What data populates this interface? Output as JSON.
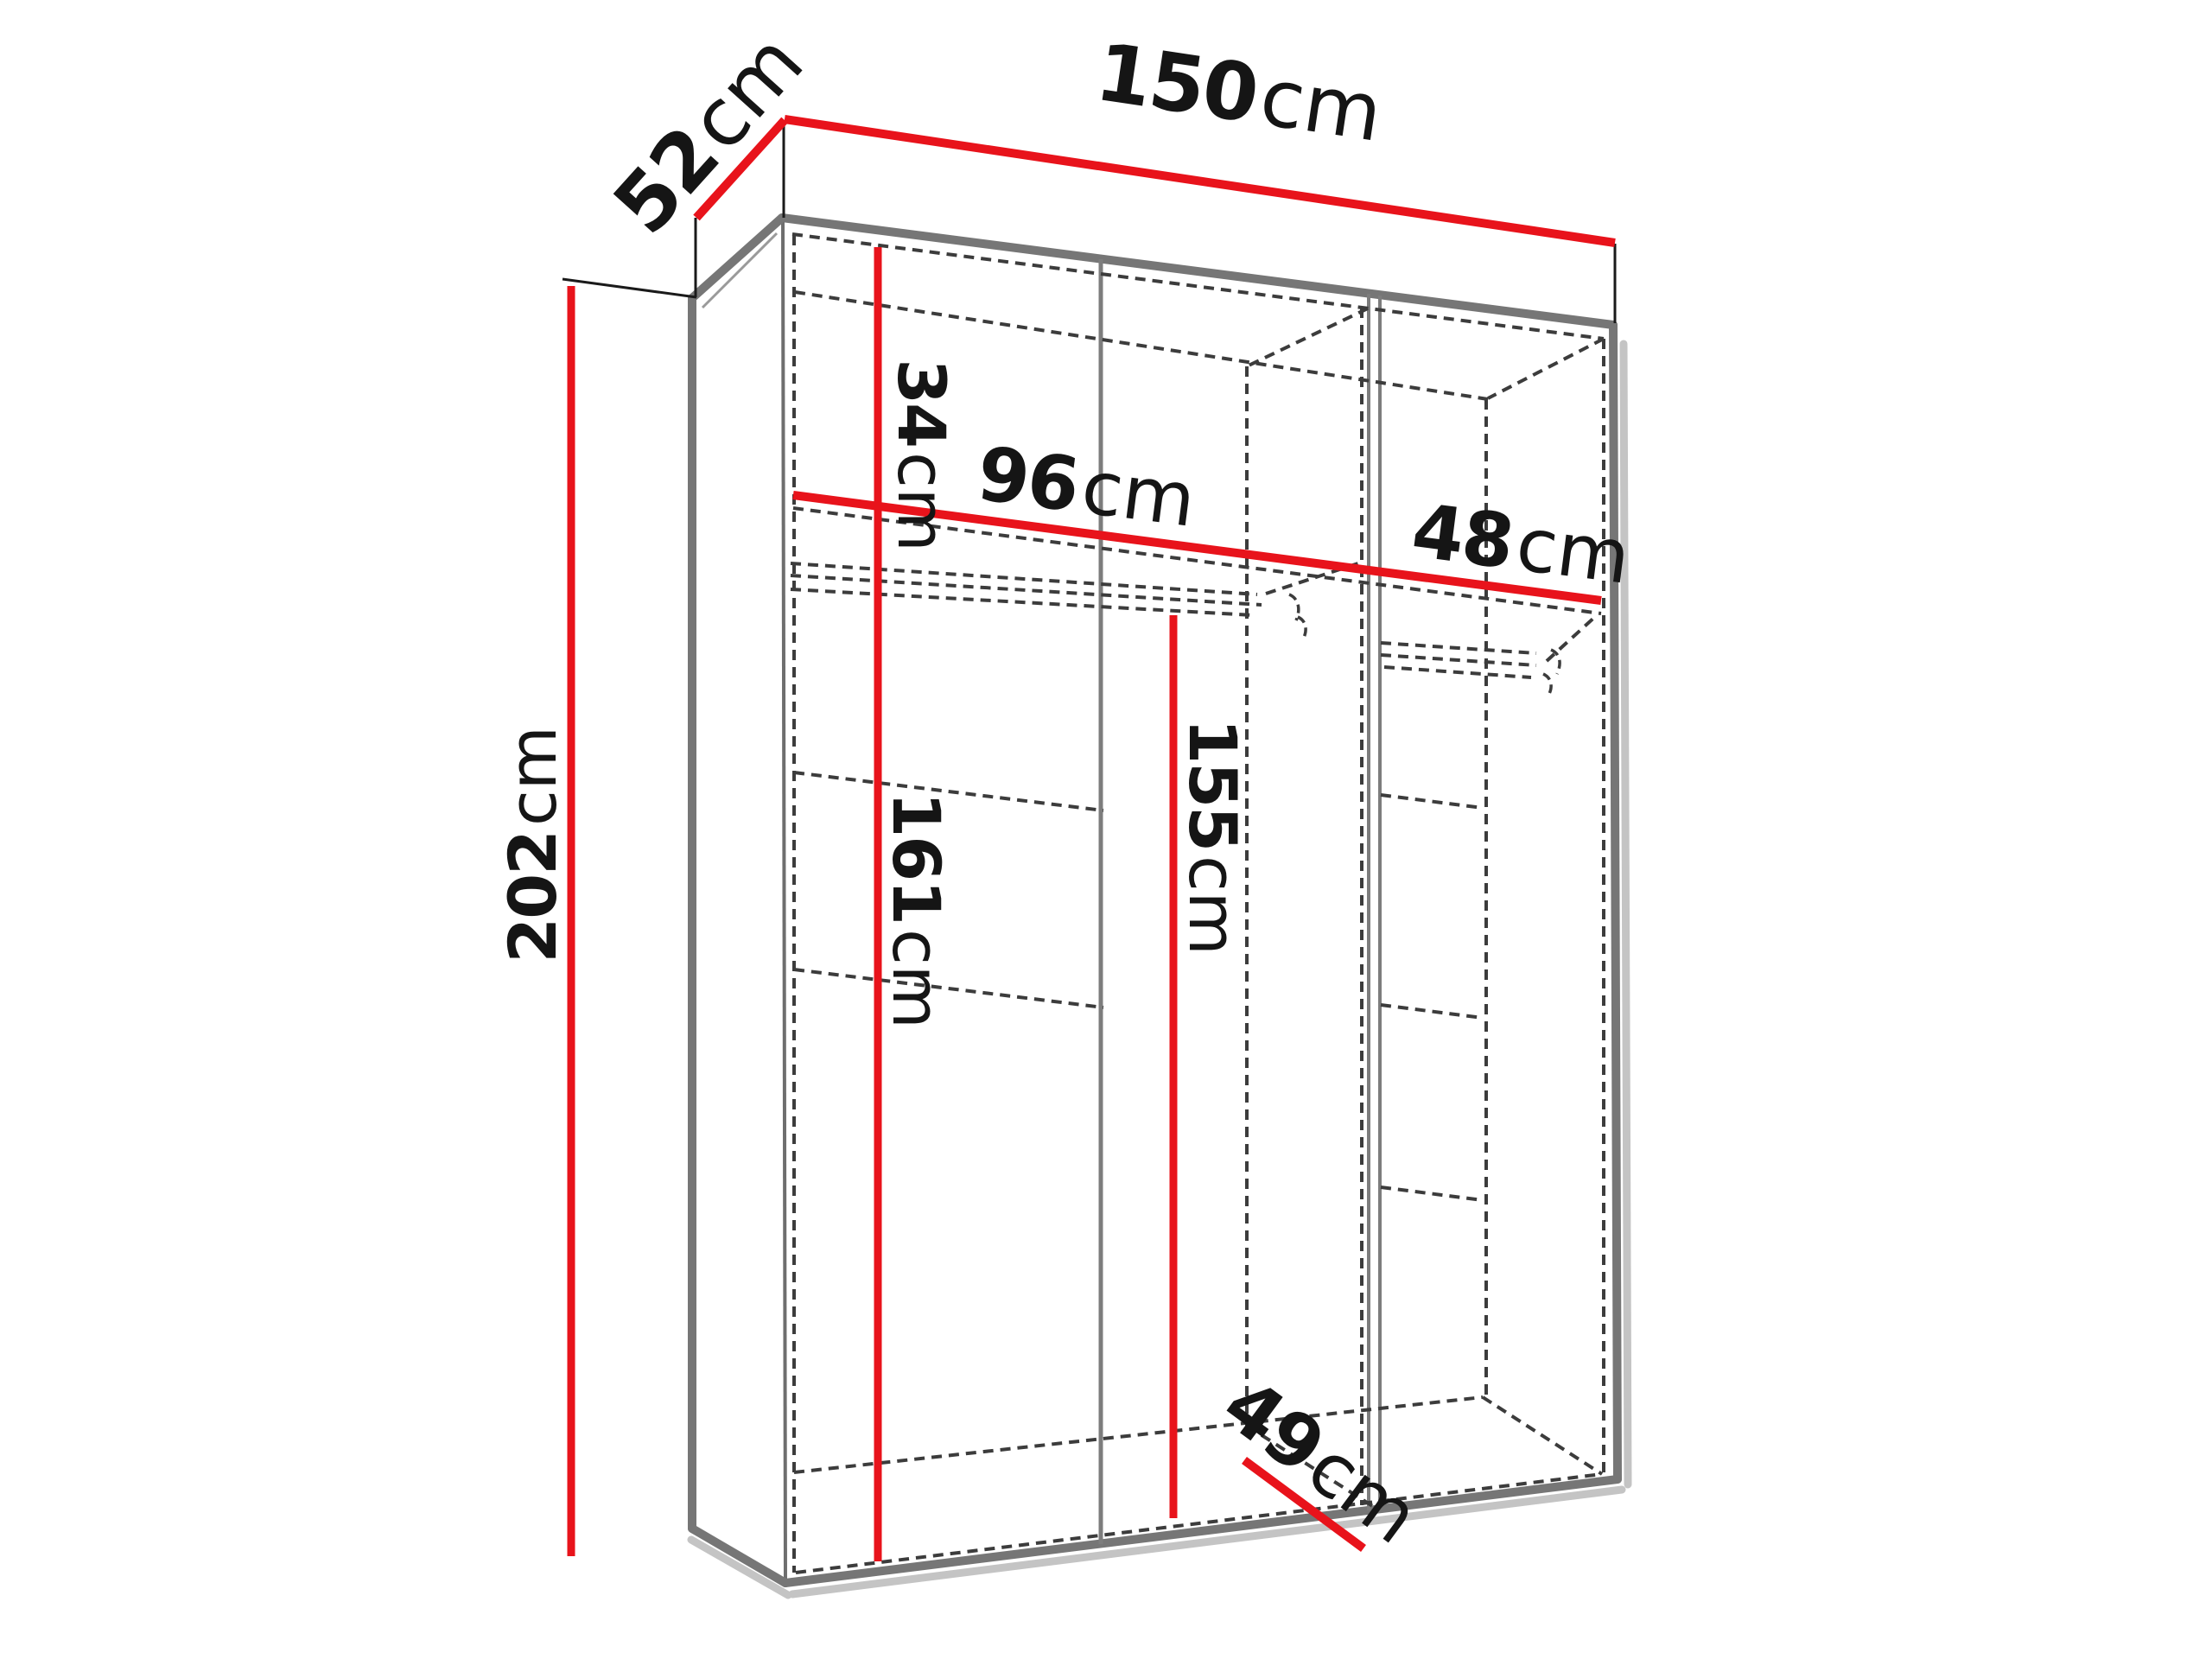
{
  "diagram": {
    "type": "furniture-dimension-schematic",
    "subject": "three-door wardrobe with interior layout shown as hidden dashed lines",
    "unit": "cm",
    "dimensions": {
      "width": {
        "value": "150",
        "unit": "cm"
      },
      "depth": {
        "value": "52",
        "unit": "cm"
      },
      "height": {
        "value": "202",
        "unit": "cm"
      },
      "top_shelf_drop": {
        "value": "34",
        "unit": "cm"
      },
      "left_section": {
        "value": "96",
        "unit": "cm"
      },
      "right_section": {
        "value": "48",
        "unit": "cm"
      },
      "left_hanging": {
        "value": "161",
        "unit": "cm"
      },
      "middle_hanging": {
        "value": "155",
        "unit": "cm"
      },
      "interior_depth": {
        "value": "49",
        "unit": "cm"
      }
    },
    "colors": {
      "dimension_line": "#e8131b",
      "panel_edge": "#767676",
      "hidden_line": "#3c3c3c",
      "drop_shadow": "#c4c4c4",
      "label_text": "#151515",
      "background": "#ffffff"
    }
  }
}
